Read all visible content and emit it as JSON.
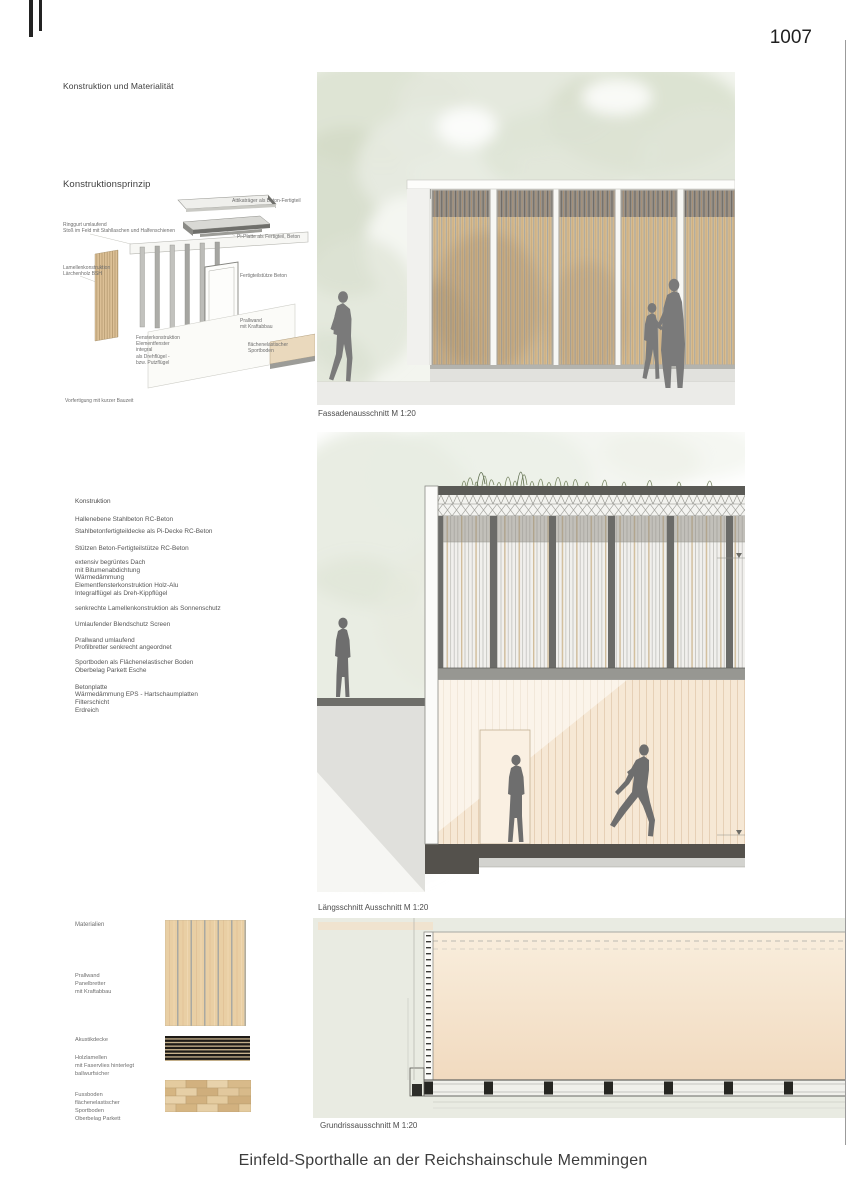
{
  "page": {
    "number": "1007",
    "title": "Einfeld-Sporthalle an der Reichshainschule Memmingen"
  },
  "headings": {
    "top": "Konstruktion und Materialität",
    "prinzip": "Konstruktionsprinzip"
  },
  "axon_labels": {
    "attika": "Attikaträger als Beton-Fertigteil",
    "pi_platte": "Pi-Platte als Fertigteil, Beton",
    "ringgurt": "Ringgurt umlaufend\nStoß im Feld mit Stahllaschen und Halfenschienen",
    "stuetze": "Fertigteilstütze Beton",
    "lamellen": "Lamellenkonstruktion\nLärchenholz BSH",
    "fenster": "Fensterkonstruktion\nElementfenster\nintegral\nals Drehflügel -\nbzw. Putzflügel",
    "prallwand": "Prallwand\nmit Kraftabbau",
    "sportboden": "flächenelastischer Sportboden",
    "footnote": "Vorfertigung mit kurzer Bauzeit"
  },
  "konstruktion": {
    "heading": "Konstruktion",
    "paragraphs": [
      "Hallenebene Stahlbeton  RC-Beton",
      "Stahlbetonfertigteildecke als Pi-Decke  RC-Beton",
      "Stützen Beton-Fertigteilstütze RC-Beton",
      "extensiv begrüntes Dach\nmit Bitumenabdichtung\nWärmedämmung\nElementfensterkonstruktion Holz-Alu\nIntegralflügel als Dreh-Kippflügel",
      "senkrechte Lamellenkonstruktion als Sonnenschutz",
      "Umlaufender Blendschutz Screen",
      "Prallwand umlaufend\nProfilbretter senkrecht angeordnet",
      "Sportboden als Flächenelastischer Boden\nOberbelag Parkett Esche",
      "Betonplatte\nWärmedämmung EPS - Hartschaumplatten\nFilterschicht\nErdreich"
    ]
  },
  "captions": {
    "fassade": "Fassadenausschnitt  M 1:20",
    "laengsschnitt": "Längsschnitt Ausschnitt M 1:20",
    "grundriss": "Grundrissausschnitt M 1:20"
  },
  "materialien": {
    "heading": "Materialien",
    "items": [
      {
        "label": "Prallwand\nPanelbretter\nmit Kraftabbau"
      },
      {
        "label": "Akustikdecke"
      },
      {
        "label": "Holzlamellen\nmit Faservlies hinterlegt\nballwurfsicher"
      },
      {
        "label": "Fussboden\nflächenelastischer\nSportboden\nOberbelag Parkett"
      }
    ]
  },
  "colors": {
    "wood_louver": "#d8bd92",
    "wood_dark": "#c8a97b",
    "tree_green": "#dde3d4",
    "plan_background": "#e9ebe2",
    "floor_beige": "#f6e8d5",
    "slab_dark": "#54514c",
    "silhouette_gray": "#7a7a7a",
    "acoustic_black": "#1d1a16"
  }
}
